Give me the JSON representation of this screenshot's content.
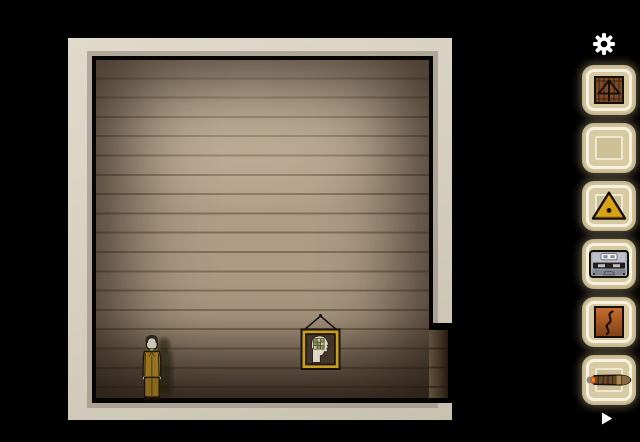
{
  "app": {
    "name": "room-escape-scene"
  },
  "palette": {
    "background": "#000000",
    "wall_cream": "#d7d0c1",
    "wood_light": "#b5a38c",
    "wood_dark": "#3a2d20",
    "slot_fill": "#d7caa2",
    "slot_border": "#f6f1de",
    "accent_gold": "#d9a413",
    "icon_white": "#ffffff"
  },
  "scene": {
    "room": "wooden-plank-room-with-bottom-right-passage",
    "character": "man-in-mustard-suit",
    "wall_art": "hanging-framed-head-profile-with-green-grid",
    "passage": "dark-opening-bottom-right"
  },
  "sidebar": {
    "settings_icon": "gear",
    "slots": [
      {
        "item": "wooden-crate-arrow"
      },
      {
        "item": "empty"
      },
      {
        "item": "warning-triangle"
      },
      {
        "item": "cassette-tape"
      },
      {
        "item": "smoke-s-tile"
      },
      {
        "item": "cigar"
      }
    ],
    "next_icon": "play-arrow"
  }
}
